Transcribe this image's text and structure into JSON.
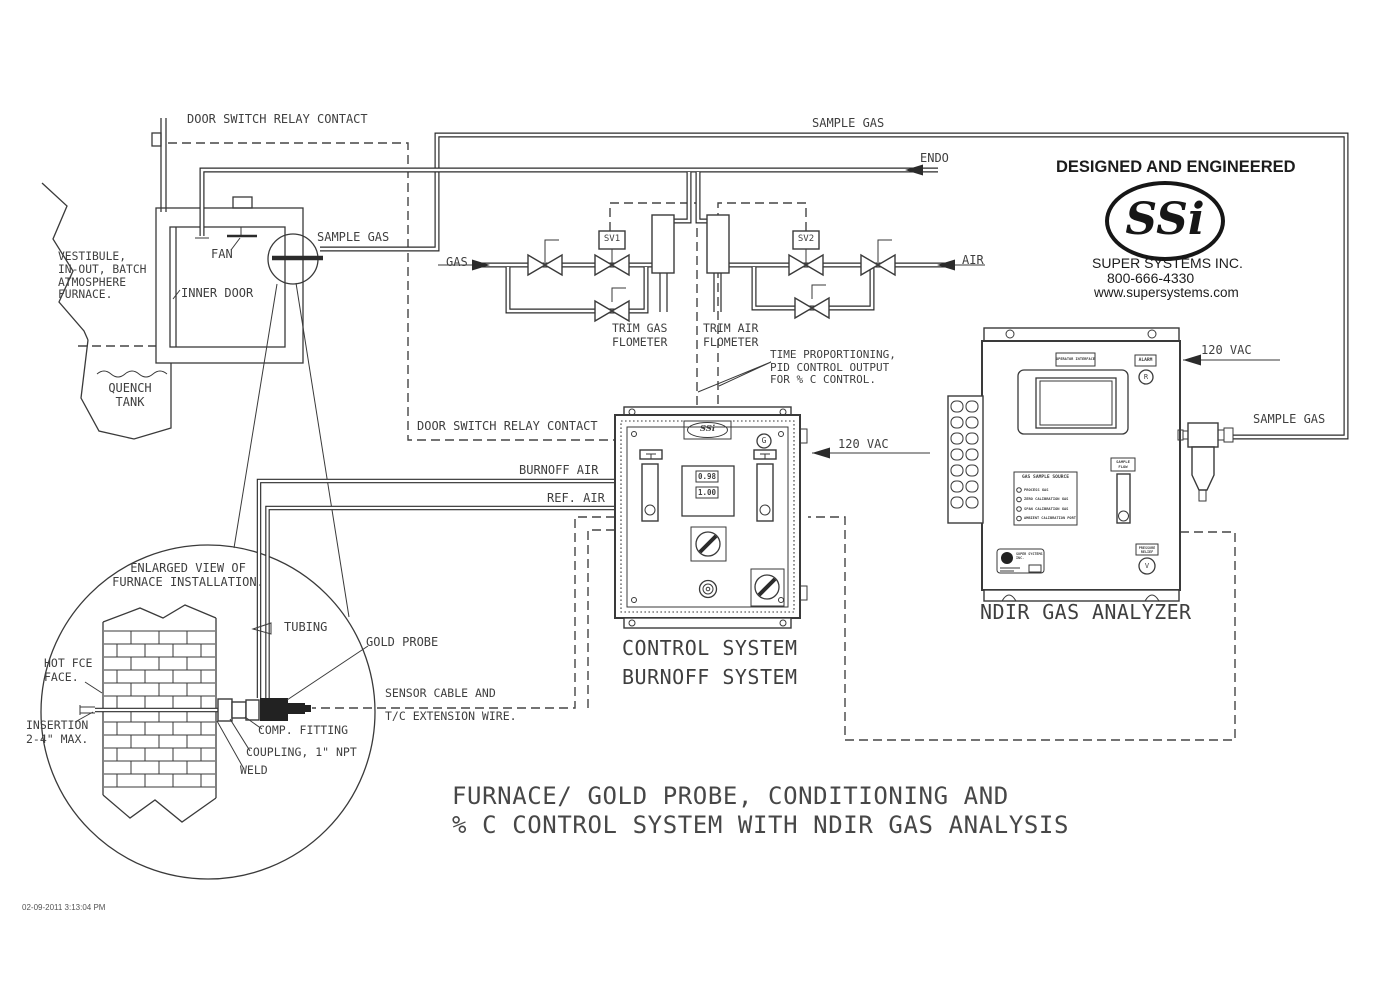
{
  "drawing": {
    "timestamp": "02-09-2011 3:13:04 PM",
    "title_l1": "FURNACE/ GOLD PROBE, CONDITIONING AND",
    "title_l2": "% C CONTROL SYSTEM WITH NDIR GAS ANALYSIS"
  },
  "branding": {
    "tagline": "DESIGNED AND ENGINEERED",
    "logo": "SSi",
    "company": "SUPER SYSTEMS INC.",
    "phone": "800-666-4330",
    "website": "www.supersystems.com"
  },
  "furnace": {
    "door_switch": "DOOR SWITCH RELAY CONTACT",
    "vestibule": "VESTIBULE,\nIN-OUT, BATCH\nATMOSPHERE\nFURNACE.",
    "fan": "FAN",
    "inner_door": "INNER DOOR",
    "sample_gas": "SAMPLE GAS",
    "quench": "QUENCH\nTANK"
  },
  "gas_train": {
    "sample_gas": "SAMPLE GAS",
    "endo": "ENDO",
    "gas": "GAS",
    "air": "AIR",
    "sv1": "SV1",
    "sv2": "SV2",
    "trim_gas": "TRIM GAS\nFLOMETER",
    "trim_air": "TRIM AIR\nFLOMETER",
    "time_prop": "TIME PROPORTIONING,\nPID CONTROL OUTPUT\nFOR % C CONTROL."
  },
  "control": {
    "door_switch": "DOOR SWITCH RELAY CONTACT",
    "vac": "120 VAC",
    "burnoff_air": "BURNOFF AIR",
    "ref_air": "REF. AIR",
    "name": "CONTROL SYSTEM\nBURNOFF SYSTEM",
    "logo": "SSi",
    "ground": "G",
    "display_pv": "0.98",
    "display_sv": "1.00"
  },
  "analyzer": {
    "name": "NDIR GAS ANALYZER",
    "vac": "120 VAC",
    "sample_gas": "SAMPLE GAS",
    "interface_label": "OPERATOR INTERFACE",
    "alarm": "ALARM",
    "reset": "R",
    "source_title": "GAS SAMPLE SOURCE",
    "source_opt1": "PROCESS GAS",
    "source_opt2": "ZERO CALIBRATION GAS",
    "source_opt3": "SPAN CALIBRATION GAS",
    "source_opt4": "AMBIENT CALIBRATION PORT",
    "flow_label": "SAMPLE\nFLOW",
    "relief_label": "PRESSURE\nRELIEF",
    "valve_glyph": "V",
    "tag": "SUPER SYSTEMS\nINC."
  },
  "probe": {
    "enlarged": "ENLARGED VIEW OF\nFURNACE INSTALLATION.",
    "tubing": "TUBING",
    "gold_probe": "GOLD PROBE",
    "hot_face": "HOT FCE\nFACE.",
    "insertion": "INSERTION\n2-4\" MAX.",
    "comp_fitting": "COMP. FITTING",
    "coupling": "COUPLING, 1\" NPT",
    "weld": "WELD",
    "sensor_1": "SENSOR CABLE AND",
    "sensor_2": "T/C EXTENSION WIRE."
  },
  "colors": {
    "line": "#3a3a3a",
    "pipe": "#2b2b2b",
    "text": "#3f3f3f",
    "background": "#ffffff"
  }
}
